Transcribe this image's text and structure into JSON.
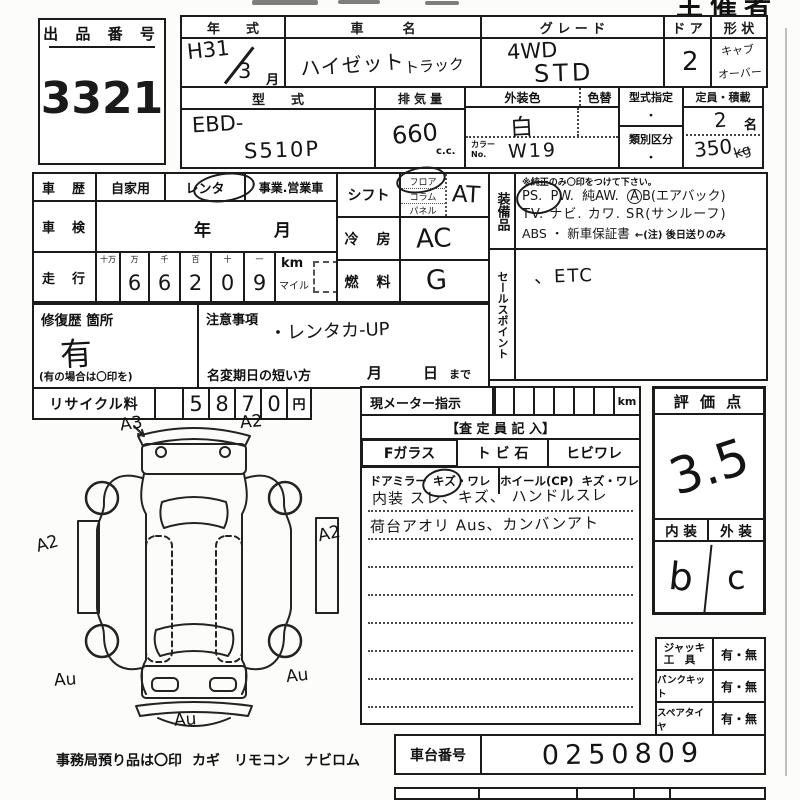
{
  "page": {
    "corner": "主催者用"
  },
  "exhibit": {
    "label": "出 品 番 号",
    "number": "3321"
  },
  "top": {
    "year_label": "年　　式",
    "year_value": "H31",
    "year_month": "3",
    "month_unit": "月",
    "name_label": "車　　　名",
    "name_value": "ハイゼット",
    "name_value2": "トラック",
    "grade_label": "グ レ ー ド",
    "grade1": "4WD",
    "grade2": "STD",
    "door_label": "ド ア",
    "door_value": "2",
    "shape_label": "形 状",
    "shape1": "キャブ",
    "shape2": "オーバー",
    "model_label": "型　　式",
    "model1": "EBD-",
    "model2": "S510P",
    "disp_label": "排 気 量",
    "disp_value": "660",
    "disp_unit": "c.c.",
    "color_label": "外装色",
    "colorchg_label": "色替",
    "color_value": "白",
    "colorno_label": "カラー\nNo.",
    "colorno_value": "W19",
    "spec_label": "型式指定",
    "spec_value": "・",
    "class_label": "類別区分",
    "class_value": "・",
    "cap_label": "定員・積載",
    "cap_value": "2",
    "cap_unit": "名",
    "load_value": "350",
    "load_unit": "kg"
  },
  "history": {
    "label": "車　歴",
    "opt1": "自家用",
    "opt2": "レンタ",
    "opt3": "事業.営業車"
  },
  "shaken": {
    "label": "車　検",
    "year": "年",
    "month": "月"
  },
  "mileage": {
    "label": "走　行",
    "h1": "十万",
    "h2": "万",
    "h3": "千",
    "h4": "百",
    "h5": "十",
    "h6": "一",
    "d2": "6",
    "d3": "6",
    "d4": "2",
    "d5": "0",
    "d6": "9",
    "km": "km",
    "mile": "マイル"
  },
  "shift": {
    "label": "シフト",
    "opt1": "フロア",
    "opt2": "コラム",
    "opt3": "パネル",
    "value": "AT"
  },
  "cool": {
    "label": "冷　房",
    "value": "AC"
  },
  "fuel": {
    "label": "燃　料",
    "value": "G"
  },
  "equip": {
    "label": "装備品",
    "note": "※純正のみ〇印をつけて下さい。",
    "ps": "PS.",
    "pw": "PW.",
    "aw": "純AW.",
    "ab_a": "A",
    "ab_b": "B(エアバック)",
    "line2": "TV. ナビ. カワ. SR(サンルーフ)",
    "line3": "ABS ・ 新車保証書",
    "line3b": "←(注) 後日送りのみ"
  },
  "sales": {
    "label": "セールスポイント",
    "value": "、ETC"
  },
  "repair": {
    "label": "修復歴 箇所",
    "value": "有",
    "note": "(有の場合は〇印を)"
  },
  "caution": {
    "label": "注意事項",
    "value": "・レンタカ-UP",
    "rename": "名変期日の短い方",
    "month": "月",
    "day": "日",
    "made": "まで"
  },
  "recycle": {
    "label": "リサイクル料",
    "d1": "5",
    "d2": "8",
    "d3": "7",
    "d4": "0",
    "unit": "円"
  },
  "meter": {
    "label": "現メーター指示",
    "km": "km",
    "assessor": "【査 定 員 記 入】",
    "c1": "Fガラス",
    "c2": "ト ビ 石",
    "c3": "ヒビワレ",
    "d1": "ドアミラー",
    "d1v": "キズ・ワレ",
    "d2": "ホイール(CP)",
    "d2v": "キズ・ワレ",
    "note1": "内装 スレ、キズ、 ハンドルスレ",
    "note2": "荷台アオリ Aus、カンバンアト"
  },
  "evaluation": {
    "label": "評 価 点",
    "score": "3.5",
    "interior_label": "内 装",
    "exterior_label": "外 装",
    "interior": "b",
    "exterior": "c"
  },
  "accessories": {
    "jack_label": "ジャッキ\n工　具",
    "jack": "有・無",
    "pank_label": "パンクキット",
    "pank": "有・無",
    "spare_label": "スペアタイヤ",
    "spare": "有・無"
  },
  "chassis": {
    "label": "車台番号",
    "value": "0250809"
  },
  "diagram": {
    "a3": "A3",
    "a2_top": "A2",
    "a2_left": "A2",
    "a2_right": "A2",
    "au_bl": "Au",
    "au_br": "Au",
    "au_bottom": "Au",
    "footer_label": "事務局預り品は〇印",
    "footer_items": "カギ　リモコン　ナビロム"
  }
}
